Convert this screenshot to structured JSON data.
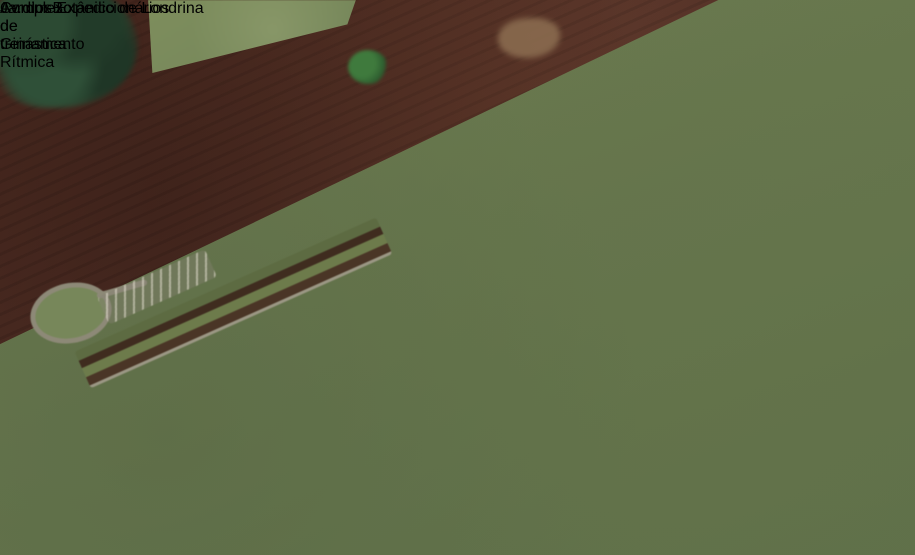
{
  "map_labels": {
    "street": {
      "text": "Av. dos Expedicionários"
    },
    "park": {
      "text": "Jardim Botânico de Londrina"
    },
    "project": {
      "line1": "Complexo de treinamento",
      "line2": "de Ginástica Rítmica"
    }
  },
  "overlay": {
    "description": "site plan rendering of the gymnastics training complex",
    "elements": [
      "building",
      "curved canopy",
      "parking lot",
      "tree rows",
      "lawn"
    ]
  },
  "colors": {
    "label_text": "#ffffff",
    "plowed_field_red": "#4f2d24",
    "vegetation_green": "#66774d",
    "forest_dark_green": "#2c4733",
    "crop_field_tan": "#c8a678",
    "dirt_road_red": "#6f3d28",
    "highway_gray": "#8d8b7c",
    "water_dark": "#2b3836",
    "overlay_plot_white": "#eceae5",
    "overlay_lawn_green": "#9fae4f"
  }
}
